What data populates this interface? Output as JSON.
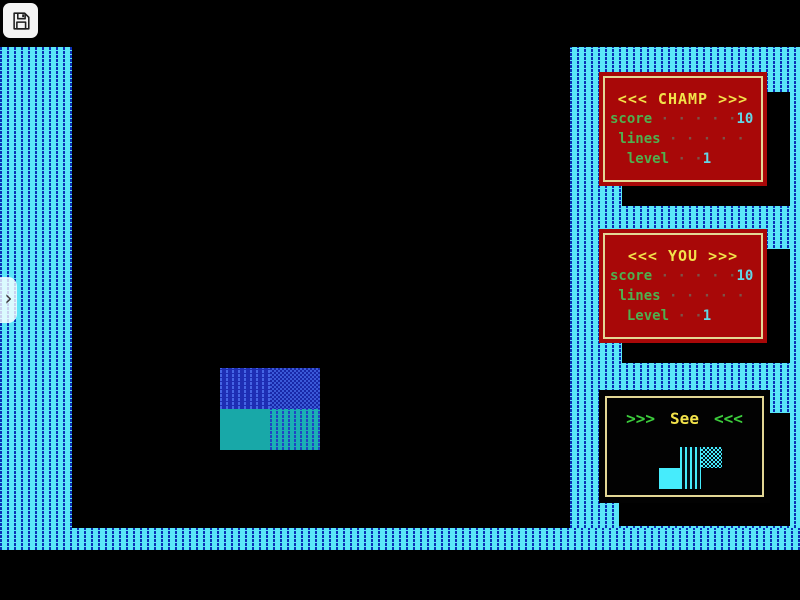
{
  "toolbar": {
    "save_icon": "floppy-disk-icon"
  },
  "sidebar_toggle": {
    "glyph": "›"
  },
  "panels": {
    "champ": {
      "title": "<<< CHAMP >>>",
      "rows": [
        {
          "label": "score",
          "dots": " · · · · ·",
          "value": "10"
        },
        {
          "label": " lines",
          "dots": " · · · · ·",
          "value": ""
        },
        {
          "label": "  level",
          "dots": " · ·",
          "value": "1"
        }
      ]
    },
    "you": {
      "title": "<<< YOU >>>",
      "rows": [
        {
          "label": "score",
          "dots": " · · · · ·",
          "value": "10"
        },
        {
          "label": " lines",
          "dots": " · · · · ·",
          "value": ""
        },
        {
          "label": "  Level",
          "dots": " · ·",
          "value": "1"
        }
      ]
    },
    "see": {
      "prefix": ">>>",
      "title": "See",
      "suffix": "<<<"
    }
  },
  "game": {
    "falling_piece": "O-tetromino, blue top row / teal bottom row, 2x2 blocks",
    "next_piece": "S-tetromino, cyan"
  },
  "colors": {
    "background": "#000000",
    "wall_cyan": "#5AE6F8",
    "wall_dash_blue": "#0B2FB6",
    "panel_red": "#A80808",
    "panel_border_yellow": "#E3D795",
    "title_yellow": "#F2E24A",
    "label_green": "#4FB04F",
    "value_cyan": "#63D6E6",
    "dots_brown": "#7C5348",
    "see_chevron_green": "#3CCC3C",
    "piece_blue": "#1E2EB4",
    "piece_teal": "#18A8A8",
    "next_piece_cyan": "#46ECFC"
  }
}
